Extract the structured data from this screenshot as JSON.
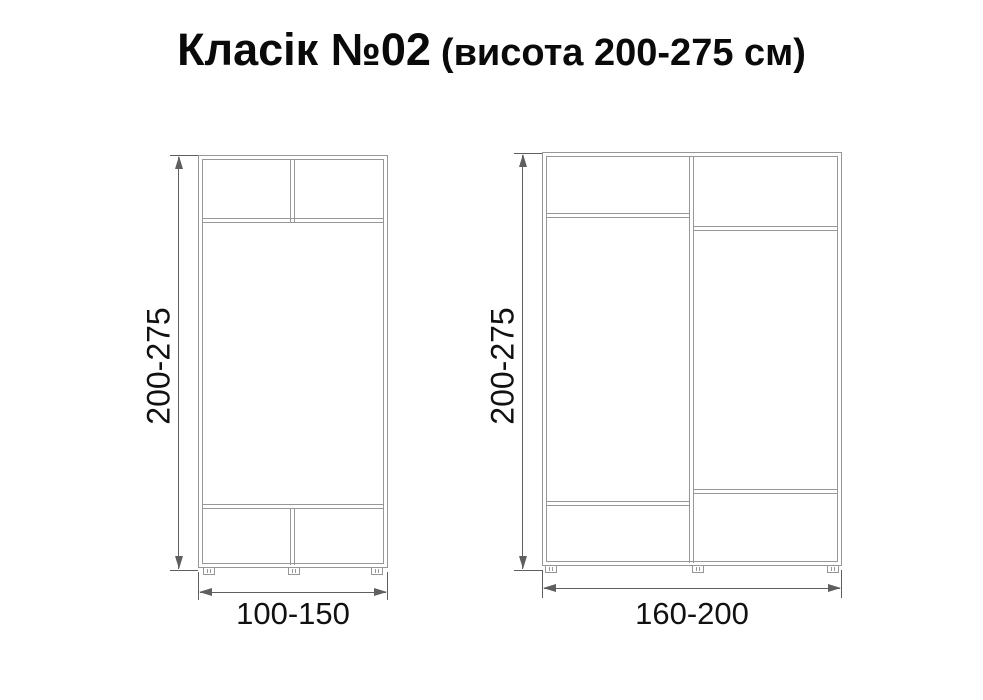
{
  "title": {
    "main": "Класік №02",
    "sub": "(висота 200-275 см)"
  },
  "figures": [
    {
      "name": "wardrobe-small",
      "height_label": "200-275",
      "width_label": "100-150"
    },
    {
      "name": "wardrobe-large",
      "height_label": "200-275",
      "width_label": "160-200"
    }
  ],
  "colors": {
    "cabinet_line": "#979797",
    "dimension_line": "#5f5f5f",
    "text": "#111111",
    "background": "#ffffff"
  }
}
